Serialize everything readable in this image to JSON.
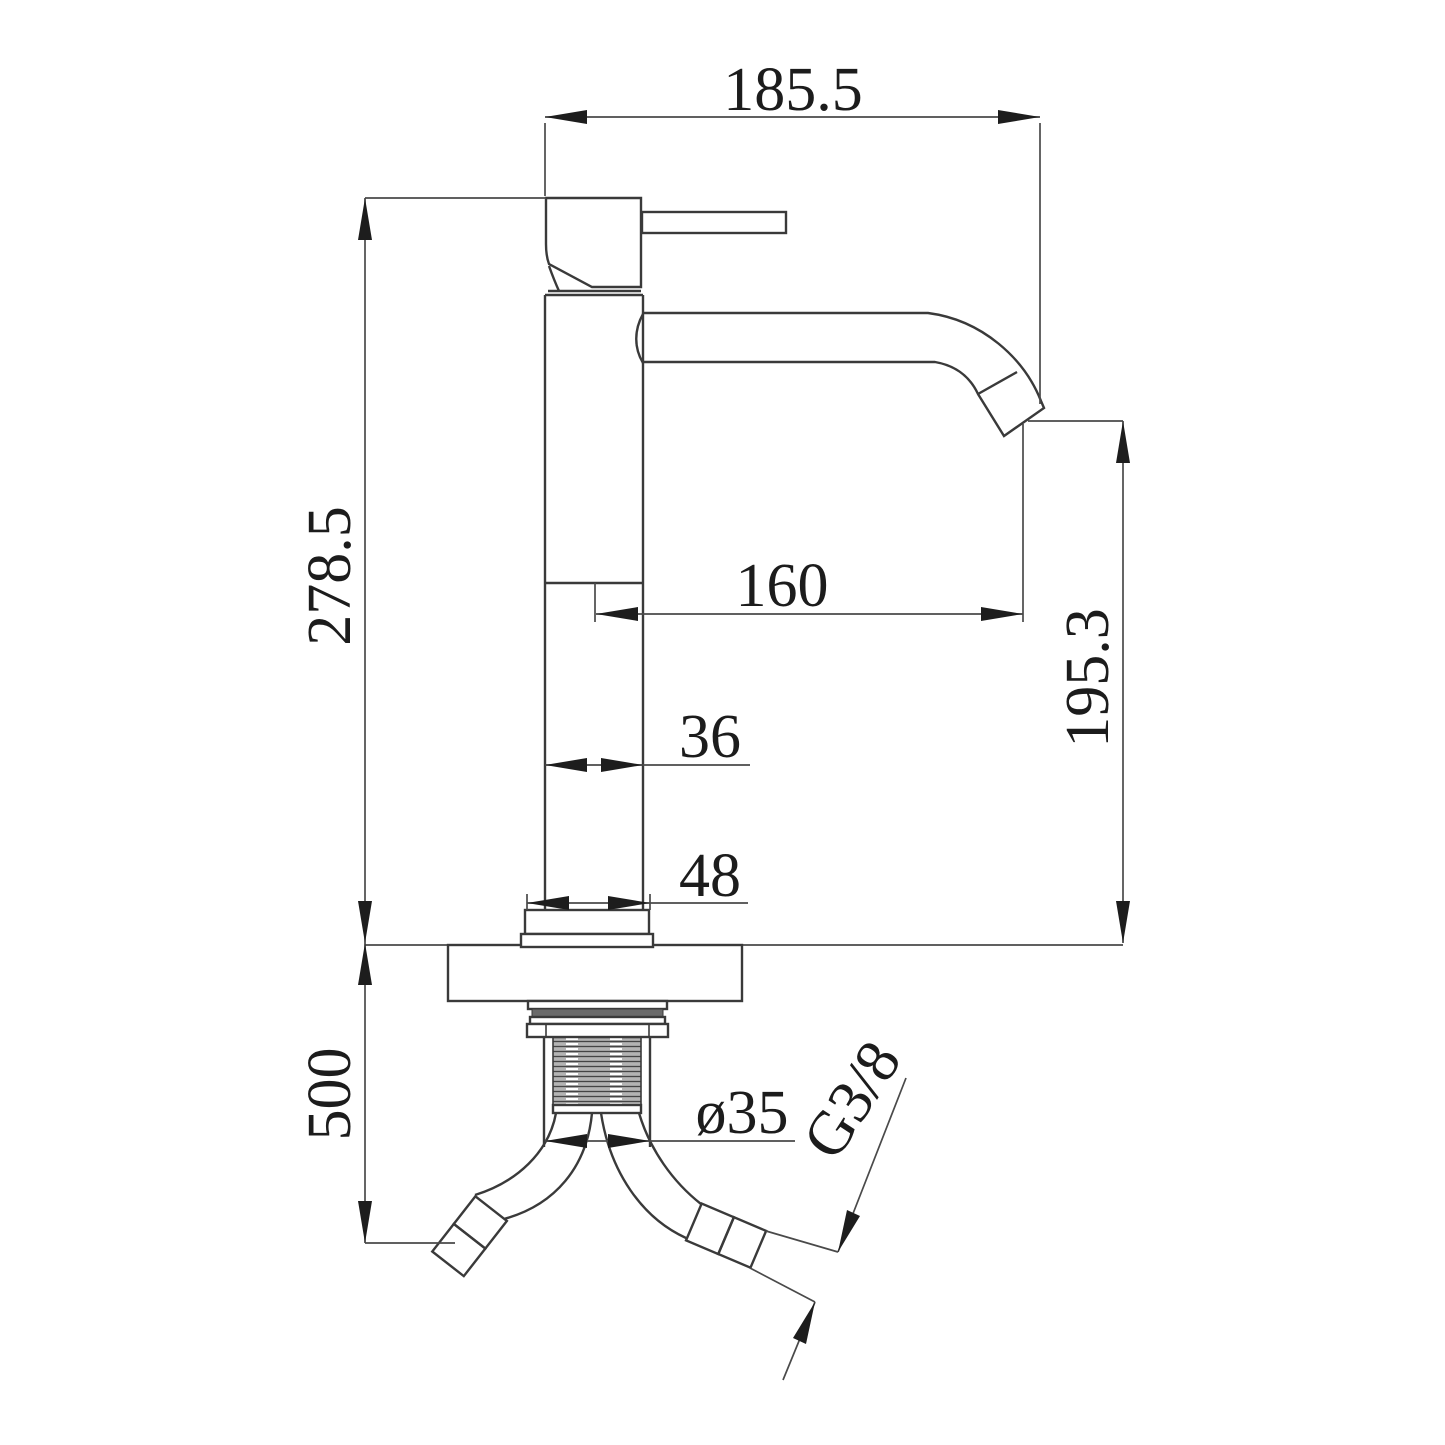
{
  "page": {
    "type": "technical-dimension-drawing",
    "subject": "Single-lever basin mixer faucet, side elevation with installation dimensions",
    "units": "mm"
  },
  "colors": {
    "bg": "#ffffff",
    "ink": "#3a3a3a",
    "dim": "#4a4a4a",
    "arrow": "#1d1d1d",
    "text": "#1c1c1c"
  },
  "dimensions": {
    "overall_width": "185.5",
    "height_above_counter": "278.5",
    "spout_reach": "160",
    "body_width": "36",
    "base_width": "48",
    "spout_outlet_height": "195.3",
    "supply_hose_length": "500",
    "shank_diameter": "ø35",
    "hose_thread": "G3/8"
  }
}
